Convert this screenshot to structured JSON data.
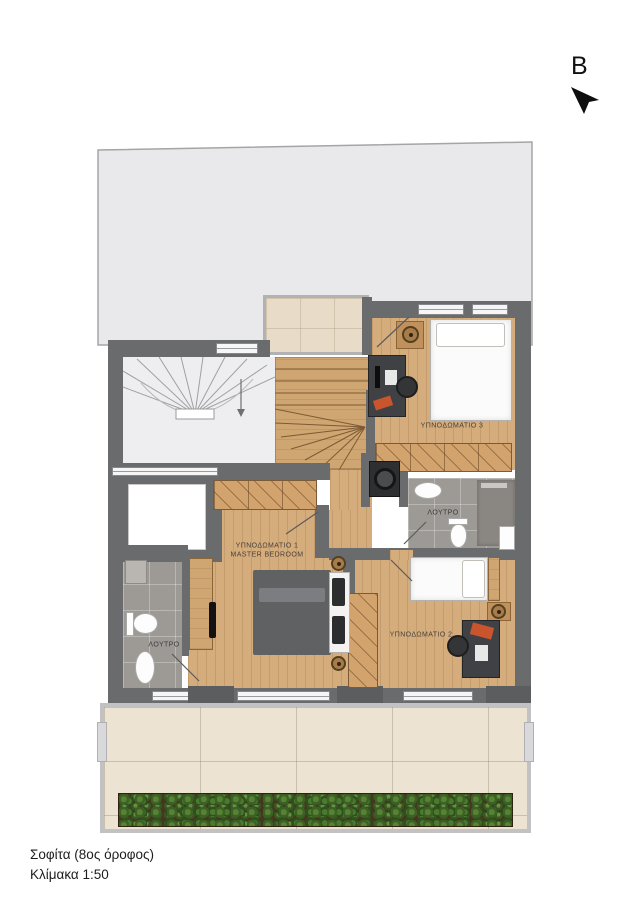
{
  "compass": {
    "label": "B"
  },
  "plan": {
    "rooms": {
      "bedroom3": {
        "label": "ΥΠΝΟΔΩΜΑΤΙΟ 3"
      },
      "bathroom_upper": {
        "label": "ΛΟΥΤΡΟ"
      },
      "master_bedroom": {
        "label_line1": "ΥΠΝΟΔΩΜΑΤΙΟ 1",
        "label_line2": "MASTER BEDROOM"
      },
      "bathroom_lower": {
        "label": "ΛΟΥΤΡΟ"
      },
      "bedroom2": {
        "label": "ΥΠΝΟΔΩΜΑΤΙΟ 2"
      }
    },
    "colors": {
      "wall": "#6a6b6d",
      "wood_floor": "#d5ac7c",
      "roof": "#e9e9eb",
      "bath_tile": "#9d9a95",
      "terrace_tile": "#ede3d3",
      "plants_green": "#4a7a2e",
      "soil_brown": "#47361f"
    }
  },
  "footer": {
    "title": "Σοφίτα (8ος όροφος)",
    "scale": "Κλίμακα 1:50"
  }
}
